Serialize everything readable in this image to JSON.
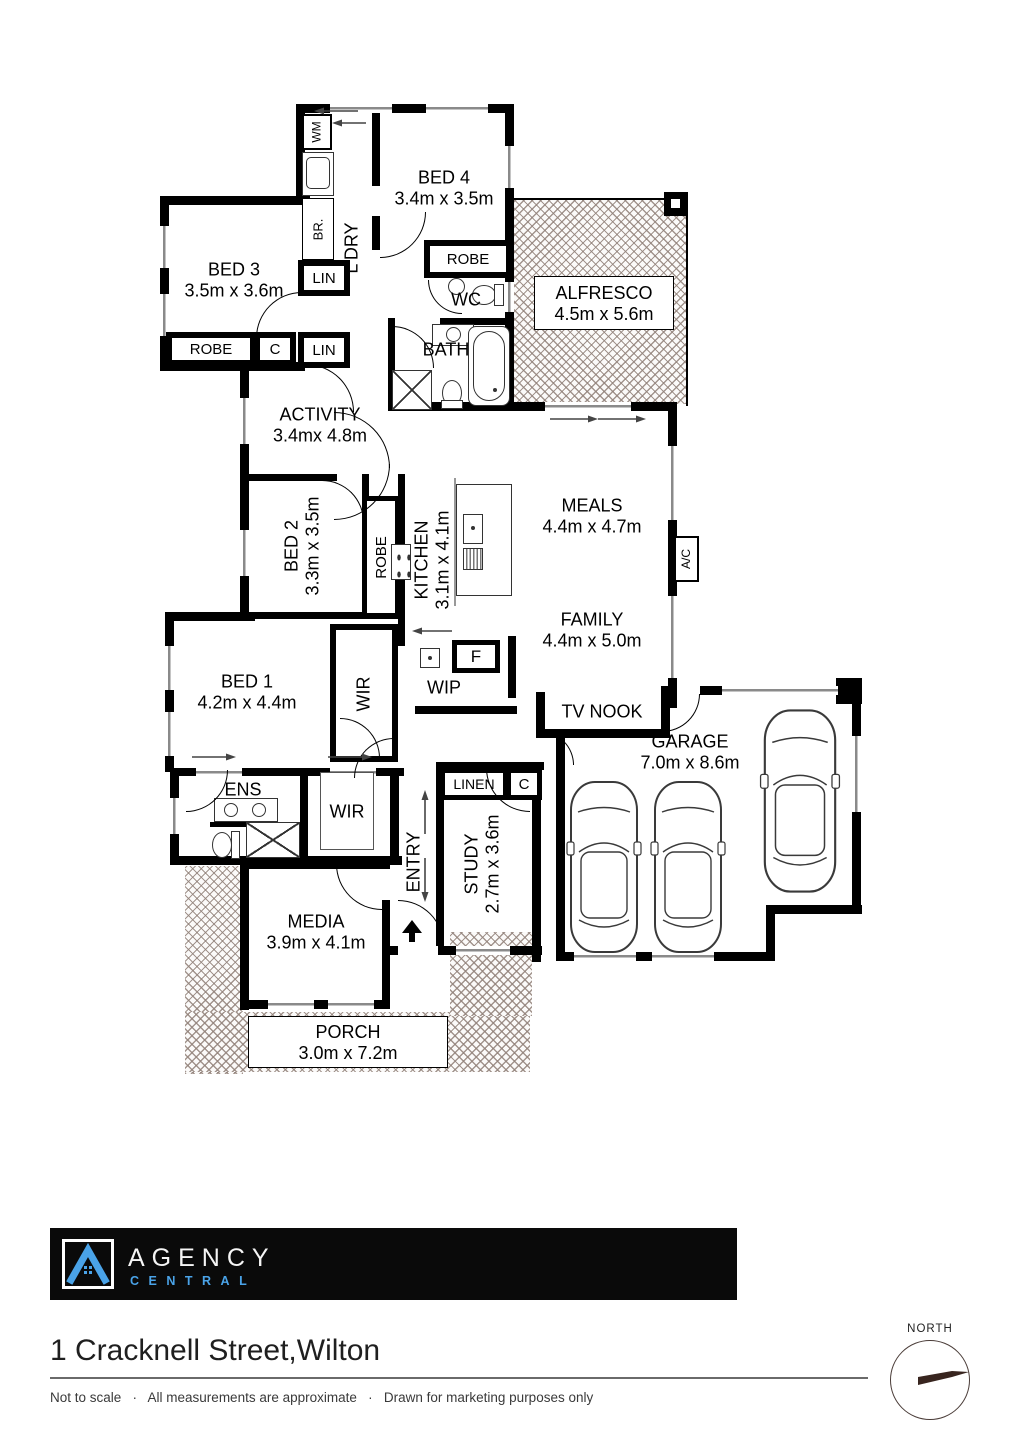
{
  "plan": {
    "rooms": {
      "bed4": {
        "name": "BED 4",
        "dims": "3.4m x 3.5m"
      },
      "bed3": {
        "name": "BED 3",
        "dims": "3.5m x 3.6m"
      },
      "ldry": {
        "name": "L'DRY"
      },
      "alfresco": {
        "name": "ALFRESCO",
        "dims": "4.5m x 5.6m"
      },
      "activity": {
        "name": "ACTIVITY",
        "dims": "3.4mx 4.8m"
      },
      "bed2": {
        "name": "BED 2",
        "dims": "3.3m x 3.5m"
      },
      "kitchen": {
        "name": "KITCHEN",
        "dims": "3.1m x 4.1m"
      },
      "meals": {
        "name": "MEALS",
        "dims": "4.4m x 4.7m"
      },
      "family": {
        "name": "FAMILY",
        "dims": "4.4m x 5.0m"
      },
      "bed1": {
        "name": "BED 1",
        "dims": "4.2m x 4.4m"
      },
      "garage": {
        "name": "GARAGE",
        "dims": "7.0m x 8.6m"
      },
      "media": {
        "name": "MEDIA",
        "dims": "3.9m x 4.1m"
      },
      "study": {
        "name": "STUDY",
        "dims": "2.7m x 3.6m"
      },
      "porch": {
        "name": "PORCH",
        "dims": "3.0m x 7.2m"
      },
      "bath": {
        "name": "BATH"
      },
      "wc": {
        "name": "WC"
      },
      "ens": {
        "name": "ENS"
      },
      "entry": {
        "name": "ENTRY"
      },
      "tv_nook": {
        "name": "TV NOOK"
      },
      "wip": {
        "name": "WIP"
      },
      "wir": {
        "name": "WIR"
      }
    },
    "labels": {
      "robe": "ROBE",
      "lin": "LIN",
      "linen": "LINEN",
      "c": "C",
      "wm": "WM",
      "br": "BR.",
      "f": "F",
      "ac": "A/C"
    }
  },
  "footer": {
    "logo": {
      "title": "AGENCY",
      "subtitle": "CENTRAL"
    },
    "address": "1 Cracknell Street,Wilton",
    "disclaimer": "Not to scale   ·   All measurements are approximate   ·   Drawn for marketing purposes only",
    "compass_label": "NORTH"
  },
  "colors": {
    "wall": "#000000",
    "accent_blue": "#4aa3e8",
    "north_arrow": "#38251f",
    "hatch": "#92827a"
  }
}
